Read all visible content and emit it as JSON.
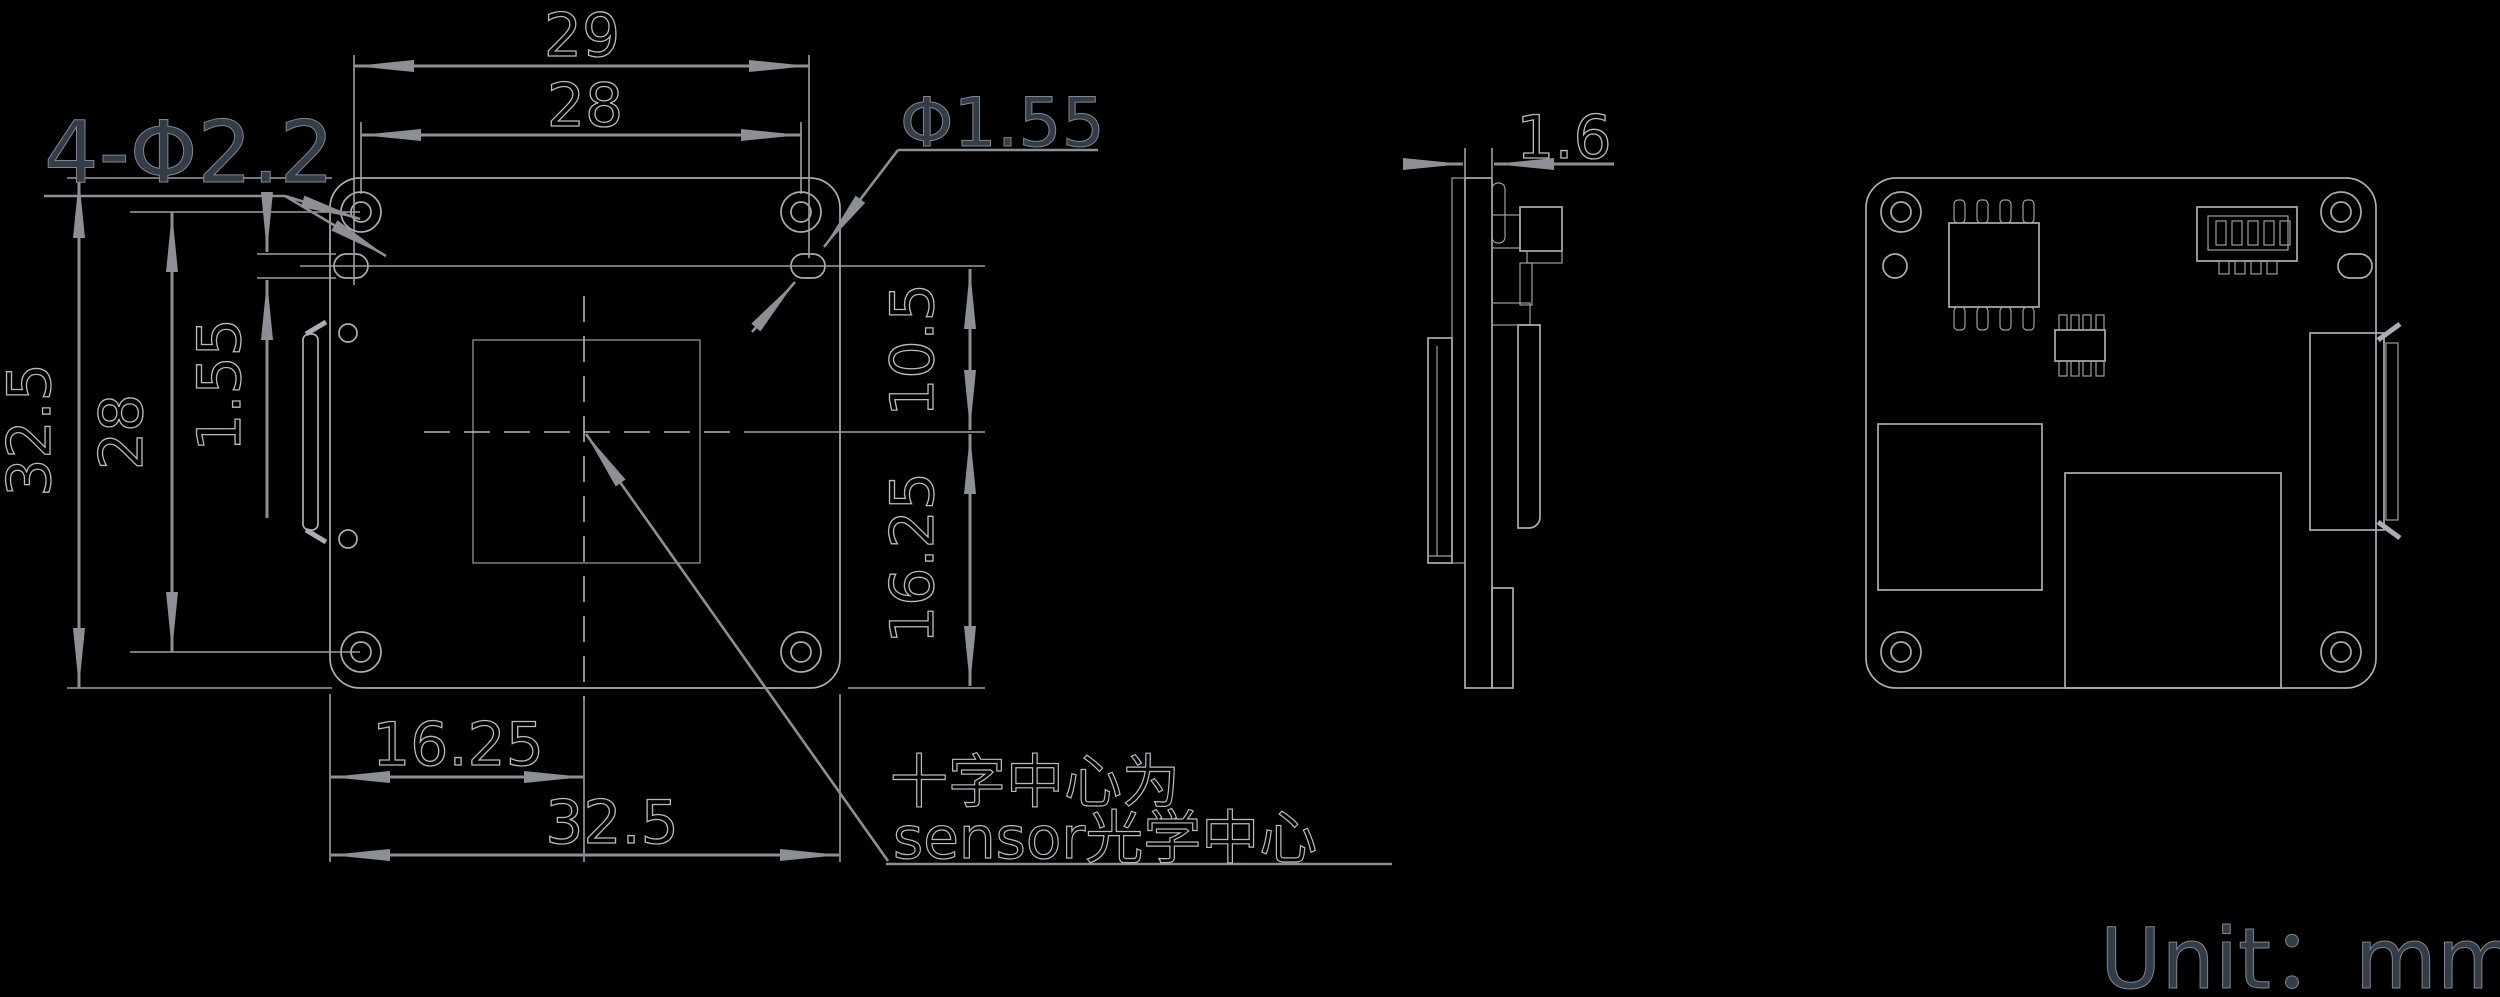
{
  "colors": {
    "background": "#000000",
    "part_line": "#a9aeb2",
    "dimension_line": "#8c9094",
    "outline_text": "#b7bcc0",
    "filled_text": "#333d48"
  },
  "labels": {
    "holes_callout": "4-Φ2.2",
    "slot_callout": "Φ1.55",
    "unit": "Unit：mm",
    "note_line1": "十字中心为",
    "note_line2": "sensor光学中心"
  },
  "dims": {
    "top_outer_width": "29",
    "top_hole_spacing": "28",
    "left_outer_height": "32.5",
    "left_hole_spacing": "28",
    "left_slot_height": "1.55",
    "right_upper": "10.5",
    "right_lower": "16.25",
    "bottom_half_width": "16.25",
    "bottom_full_width": "32.5",
    "board_thickness": "1.6"
  }
}
